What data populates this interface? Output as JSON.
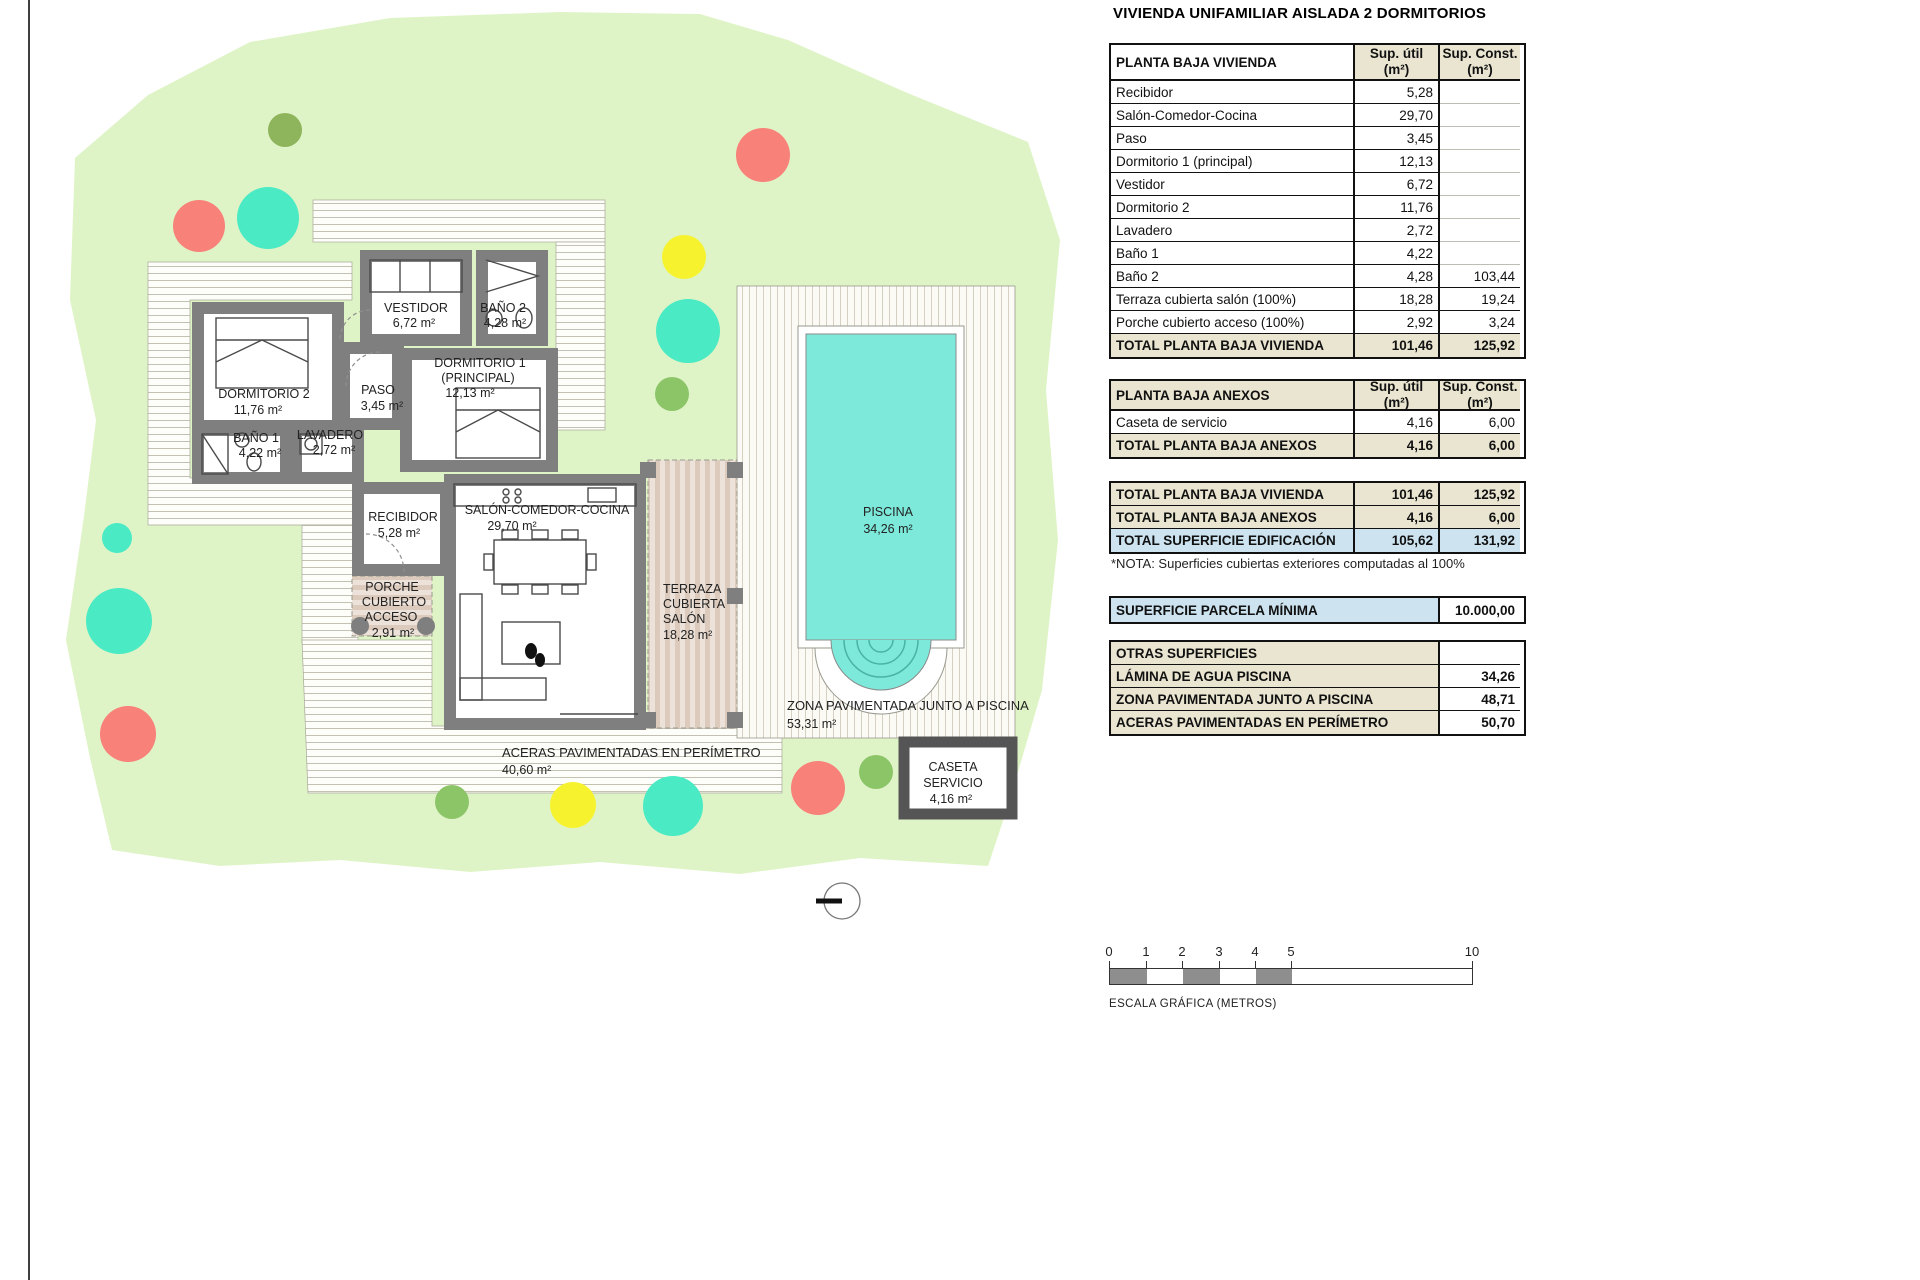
{
  "page": {
    "title": "VIVIENDA UNIFAMILIAR AISLADA 2 DORMITORIOS"
  },
  "colors": {
    "beige": "#e9e5d1",
    "blue": "#cde4f0",
    "wall": "#7f7f7f",
    "parcel": "#dff4c6",
    "pool_water": "#7de9db",
    "tree_teal": "#4aeac4",
    "tree_red": "#f8817a",
    "tree_yellow": "#f6f32e",
    "tree_olive": "#8eb55c",
    "tree_green": "#8cc468"
  },
  "t1": {
    "title": "PLANTA BAJA VIVIENDA",
    "h_util": "Sup. útil",
    "h_util2": "(m²)",
    "h_const": "Sup. Const.",
    "h_const2": "(m²)",
    "rows": [
      {
        "label": "Recibidor",
        "util": "5,28",
        "const": ""
      },
      {
        "label": "Salón-Comedor-Cocina",
        "util": "29,70",
        "const": ""
      },
      {
        "label": "Paso",
        "util": "3,45",
        "const": ""
      },
      {
        "label": "Dormitorio 1 (principal)",
        "util": "12,13",
        "const": ""
      },
      {
        "label": "Vestidor",
        "util": "6,72",
        "const": ""
      },
      {
        "label": "Dormitorio 2",
        "util": "11,76",
        "const": ""
      },
      {
        "label": "Lavadero",
        "util": "2,72",
        "const": ""
      },
      {
        "label": "Baño 1",
        "util": "4,22",
        "const": ""
      },
      {
        "label": "Baño 2",
        "util": "4,28",
        "const": "103,44"
      },
      {
        "label": "Terraza cubierta salón (100%)",
        "util": "18,28",
        "const": "19,24"
      },
      {
        "label": "Porche cubierto acceso (100%)",
        "util": "2,92",
        "const": "3,24"
      }
    ],
    "total": {
      "label": "TOTAL PLANTA BAJA VIVIENDA",
      "util": "101,46",
      "const": "125,92"
    }
  },
  "t2": {
    "title": "PLANTA BAJA ANEXOS",
    "h_util": "Sup. útil",
    "h_util2": "(m²)",
    "h_const": "Sup. Const.",
    "h_const2": "(m²)",
    "rows": [
      {
        "label": "Caseta de servicio",
        "util": "4,16",
        "const": "6,00"
      }
    ],
    "total": {
      "label": "TOTAL PLANTA BAJA ANEXOS",
      "util": "4,16",
      "const": "6,00"
    }
  },
  "t3": {
    "rows": [
      {
        "label": "TOTAL PLANTA BAJA VIVIENDA",
        "util": "101,46",
        "const": "125,92"
      },
      {
        "label": "TOTAL PLANTA BAJA ANEXOS",
        "util": "4,16",
        "const": "6,00"
      },
      {
        "label": "TOTAL SUPERFICIE EDIFICACIÓN",
        "util": "105,62",
        "const": "131,92"
      }
    ]
  },
  "nota": "*NOTA: Superficies cubiertas exteriores computadas al 100%",
  "parcela": {
    "label": "SUPERFICIE PARCELA MÍNIMA",
    "value": "10.000,00"
  },
  "otras": {
    "title": "OTRAS SUPERFICIES",
    "rows": [
      {
        "label": "LÁMINA DE AGUA PISCINA",
        "value": "34,26"
      },
      {
        "label": "ZONA PAVIMENTADA JUNTO A PISCINA",
        "value": "48,71"
      },
      {
        "label": "ACERAS PAVIMENTADAS EN PERÍMETRO",
        "value": "50,70"
      }
    ]
  },
  "scalebar": {
    "t0": "0",
    "t1": "1",
    "t2": "2",
    "t3": "3",
    "t4": "4",
    "t5": "5",
    "t10": "10",
    "label": "ESCALA GRÁFICA (METROS)"
  },
  "plan": {
    "vestidor": {
      "name": "VESTIDOR",
      "area": "6,72 m²"
    },
    "bano2": {
      "name": "BAÑO 2",
      "area": "4,28 m²"
    },
    "dormitorio2": {
      "name": "DORMITORIO 2",
      "area": "11,76 m²"
    },
    "paso": {
      "name": "PASO",
      "area": "3,45 m²"
    },
    "dormitorio1": {
      "name": "DORMITORIO 1",
      "name2": "(PRINCIPAL)",
      "area": "12,13 m²"
    },
    "bano1": {
      "name": "BAÑO 1",
      "area": "4,22 m²"
    },
    "lavadero": {
      "name": "LAVADERO",
      "area": "2,72 m²"
    },
    "recibidor": {
      "name": "RECIBIDOR",
      "area": "5,28 m²"
    },
    "salon": {
      "name": "SALÓN-COMEDOR-COCINA",
      "area": "29,70 m²"
    },
    "porche": {
      "name1": "PORCHE",
      "name2": "CUBIERTO",
      "name3": "ACCESO",
      "area": "2,91 m²"
    },
    "terraza": {
      "name1": "TERRAZA",
      "name2": "CUBIERTA",
      "name3": "SALÓN",
      "area": "18,28 m²"
    },
    "piscina": {
      "name": "PISCINA",
      "area": "34,26 m²"
    },
    "zona": {
      "name": "ZONA PAVIMENTADA JUNTO A PISCINA",
      "area": "53,31 m²"
    },
    "caseta": {
      "name1": "CASETA",
      "name2": "SERVICIO",
      "area": "4,16 m²"
    },
    "aceras": {
      "name": "ACERAS PAVIMENTADAS EN PERÍMETRO",
      "area": "40,60 m²"
    }
  }
}
